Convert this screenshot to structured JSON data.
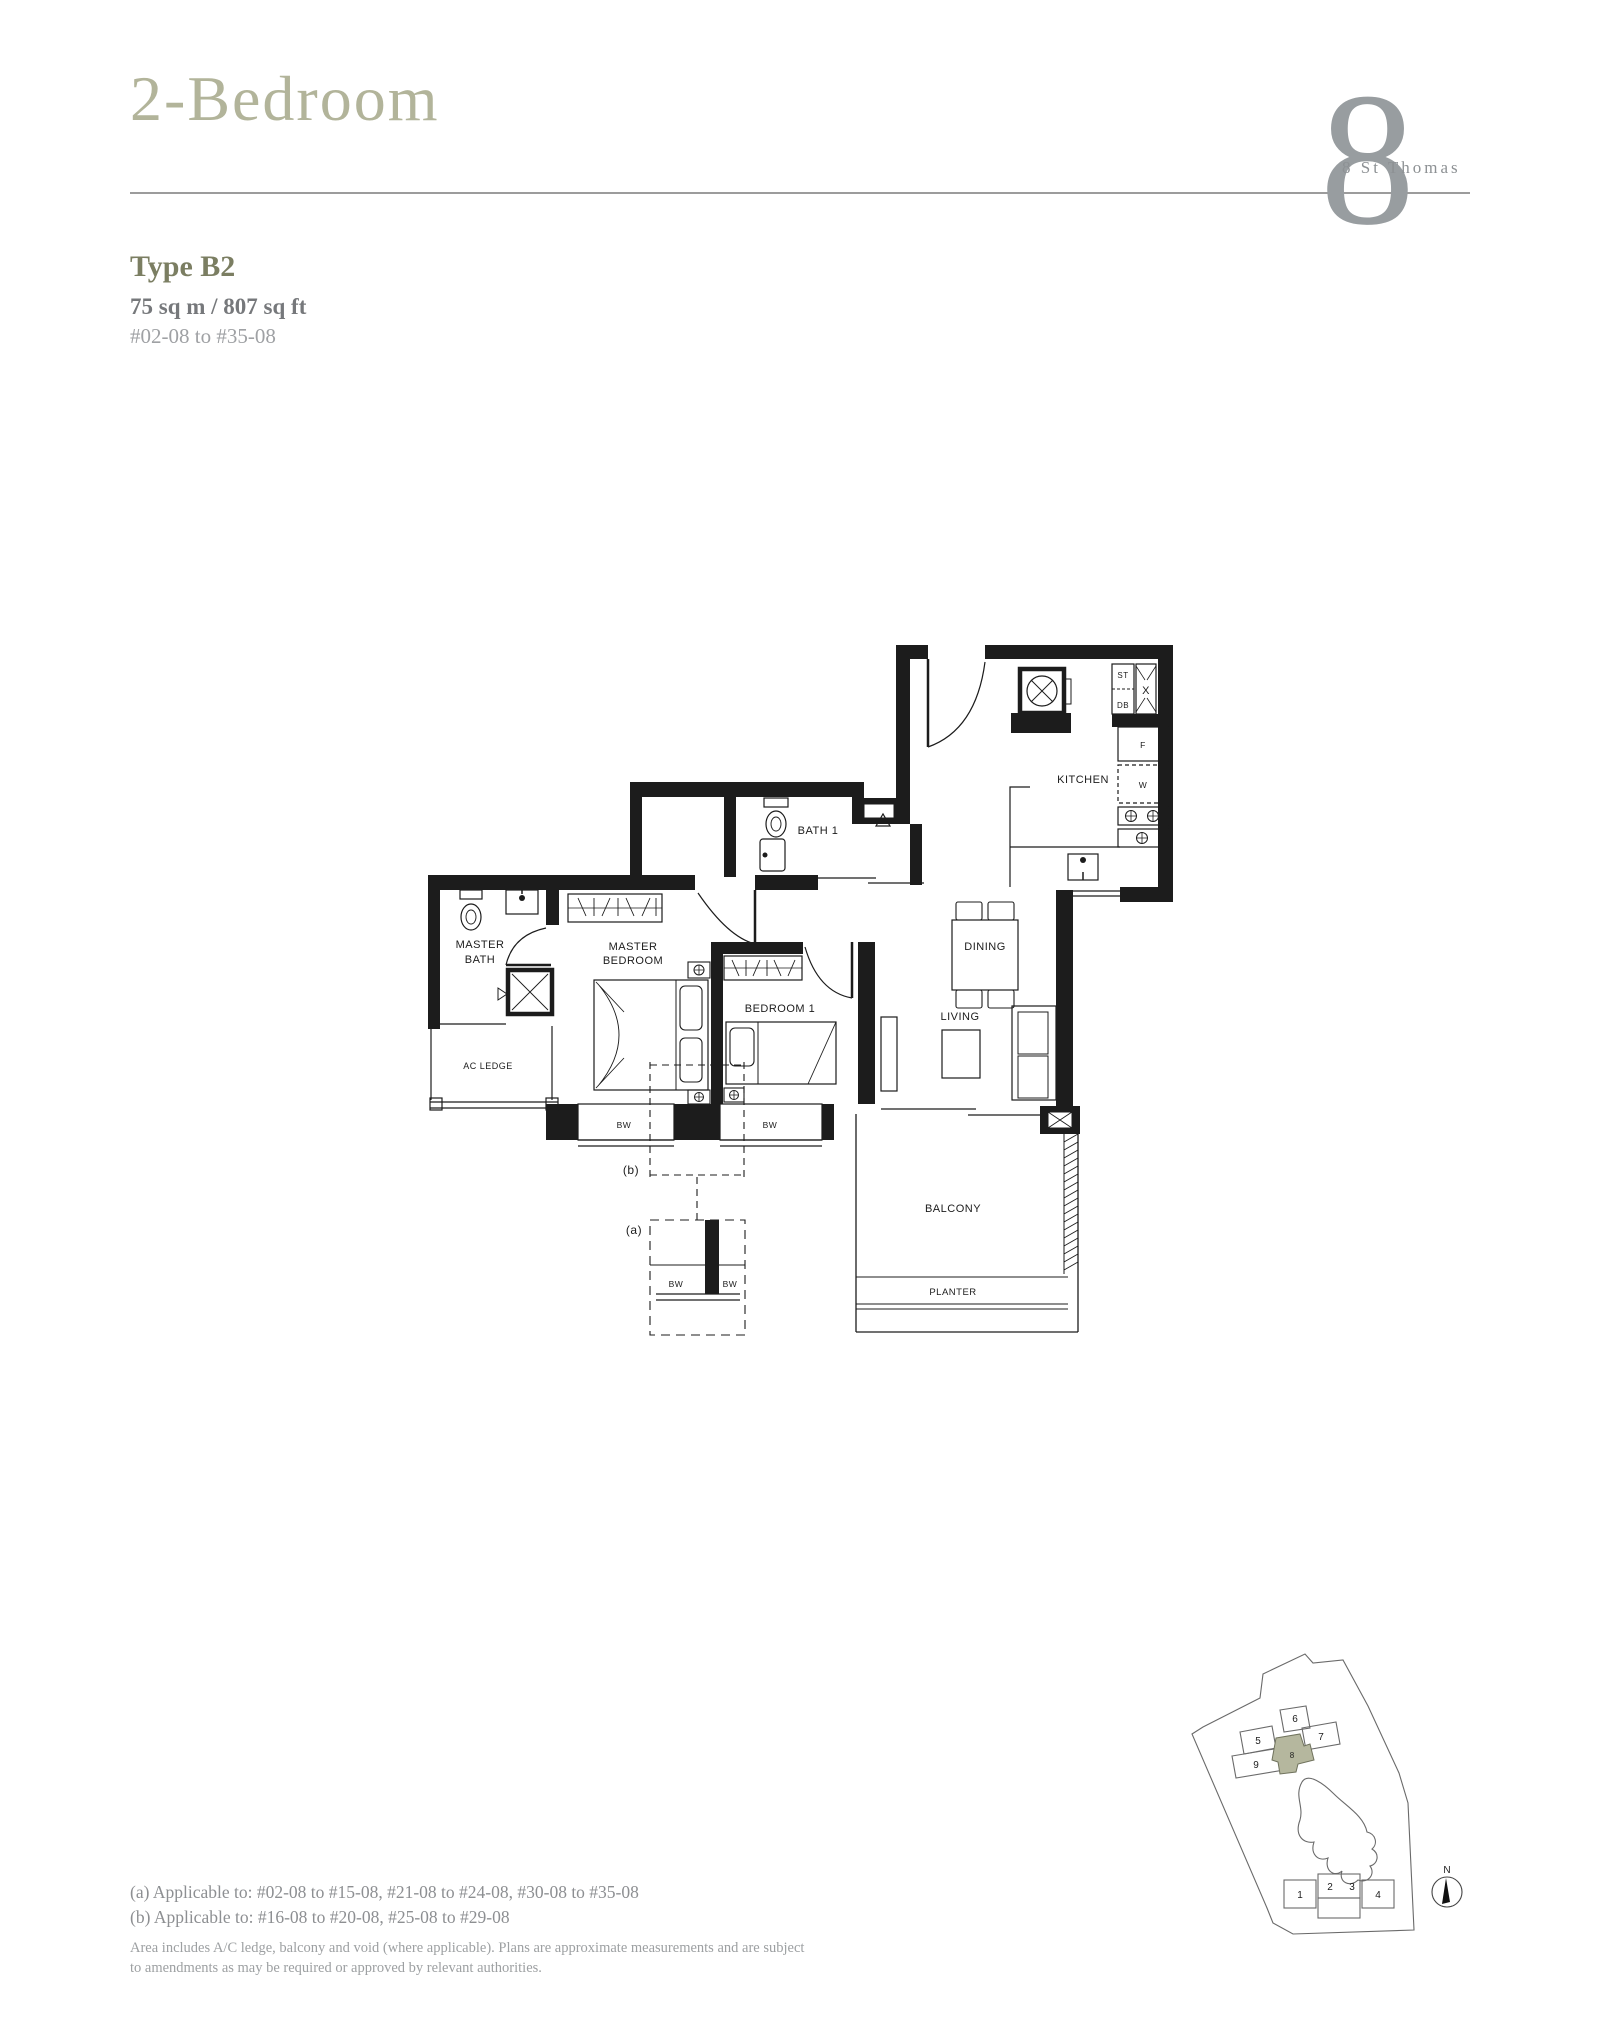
{
  "header": {
    "title": "2-Bedroom",
    "logo_glyph": "8",
    "logo_text": "8 St Thomas"
  },
  "unit": {
    "type": "Type B2",
    "area": "75 sq m / 807 sq ft",
    "stack": "#02-08 to #35-08"
  },
  "floorplan": {
    "labels": {
      "kitchen": "KITCHEN",
      "bath1": "BATH 1",
      "master_bath_1": "MASTER",
      "master_bath_2": "BATH",
      "master_bed_1": "MASTER",
      "master_bed_2": "BEDROOM",
      "bedroom1": "BEDROOM 1",
      "dining": "DINING",
      "living": "LIVING",
      "balcony": "BALCONY",
      "planter": "PLANTER",
      "ac_ledge": "AC LEDGE",
      "store": "ST",
      "db": "DB",
      "shaft": "X",
      "fridge": "F",
      "washer": "W",
      "bw": "BW",
      "detail_a": "(a)",
      "detail_b": "(b)"
    }
  },
  "notes": {
    "line_a": "(a) Applicable to: #02-08 to #15-08, #21-08 to #24-08, #30-08 to #35-08",
    "line_b": "(b) Applicable to: #16-08 to #20-08, #25-08 to #29-08",
    "disclaimer1": "Area includes A/C ledge, balcony and void (where applicable). Plans are approximate measurements and are subject",
    "disclaimer2": "to amendments as may be required or approved by relevant authorities."
  },
  "site_plan": {
    "north": "N",
    "highlight_unit": "8",
    "units": {
      "u1": "1",
      "u2": "2",
      "u3": "3",
      "u4": "4",
      "u5": "5",
      "u6": "6",
      "u7": "7",
      "u9": "9"
    }
  },
  "colors": {
    "accent_sage": "#b2b49a",
    "accent_olive": "#7b7e62",
    "plan_ink": "#1c1c1c",
    "site_highlight": "#b5b79e"
  }
}
